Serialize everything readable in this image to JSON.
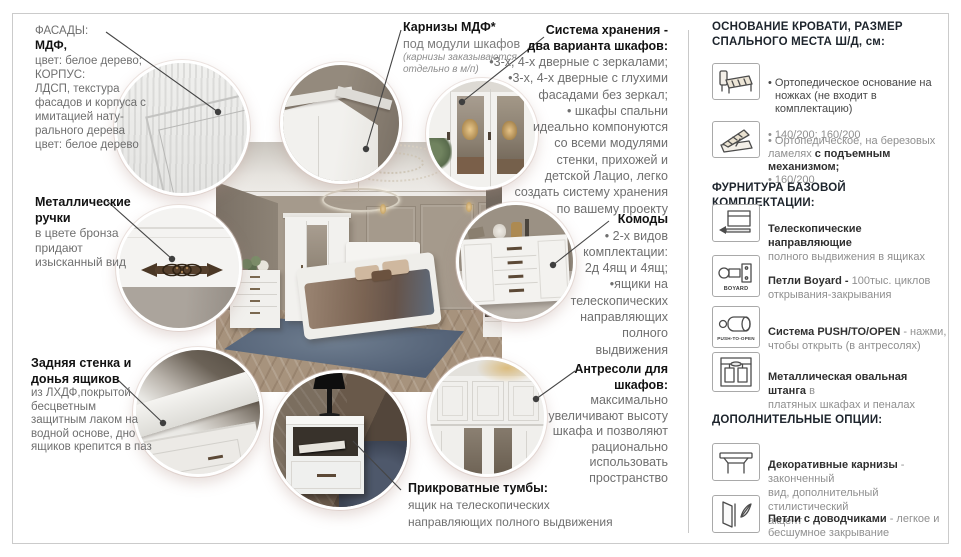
{
  "colors": {
    "body_gray": "#6f6f6f",
    "heading": "#121212",
    "sidebar_heading": "#1d242c",
    "leader_line": "#454545",
    "frame": "#cbcbcb"
  },
  "callouts": {
    "facades": {
      "label": "ФАСАДЫ:",
      "bold": "МДФ,",
      "body": "цвет: белое дерево;\nКОРПУС:\nЛДСП, текстура\nфасадов и корпуса с\nимитацией нату-\nрального дерева\nцвет: белое дерево"
    },
    "handles": {
      "title": "Металлические\nручки",
      "body": "в цвете бронза\nпридают\nизысканный вид"
    },
    "back_panel": {
      "title": "Задняя стенка и\nдонья ящиков",
      "body": "из ЛХДФ,покрытой\nбесцветным\nзащитным лаком на\nводной основе, дно\nящиков крепится в паз"
    },
    "cornices": {
      "title": "Карнизы МДФ*",
      "subtitle": "под модули шкафов",
      "note": "(карнизы заказываются\nотдельно в м/п)"
    },
    "storage": {
      "title": "Система хранения -\nдва варианта шкафов:",
      "body": "•3-х, 4-х дверные с зеркалами;\n•3-х, 4-х дверные с глухими\nфасадами без зеркал;\n• шкафы спальни\nидеально компонуются\nсо всеми модулями\nстенки, прихожей и\nдетской Лацио, легко\nсоздать систему хранения\nпо вашему проекту"
    },
    "dressers": {
      "title": "Комоды",
      "body": "• 2-х видов\nкомплектации:\n2д 4ящ и 4ящ;\n•ящики на\nтелескопических\nнаправляющих\nполного\nвыдвижения"
    },
    "mezzanines": {
      "title": "Антресоли для\nшкафов:",
      "body": "максимально\nувеличивают высоту\nшкафа и позволяют\nрационально\nиспользовать\nпространство"
    },
    "nightstands": {
      "title": "Прикроватные тумбы:",
      "body": "ящик на телескопических\nнаправляющих полного выдвижения"
    }
  },
  "sidebar": {
    "section1": {
      "title": "ОСНОВАНИЕ КРОВАТИ, РАЗМЕР\nСПАЛЬНОГО МЕСТА Ш/Д, см:",
      "items": [
        {
          "icon": "bed-base-icon",
          "dark": "• Ортопедическое основание на\nножках (не входит в комплектацию)",
          "gray": "• 140/200; 160/200"
        },
        {
          "icon": "lift-bed-icon",
          "gray1": "• Ортопедическое, на березовых\nламелях ",
          "bold": "с подъемным механизмом;",
          "gray2": "\n• 160/200"
        }
      ]
    },
    "section2": {
      "title": "ФУРНИТУРА БАЗОВОЙ КОМПЛЕКТАЦИИ:",
      "items": [
        {
          "icon": "telescopic-slides-icon",
          "lead": "Телескопические направляющие",
          "rest": "\nполного выдвижения в ящиках"
        },
        {
          "icon": "boyard-hinge-icon",
          "icon_label": "BOYARD",
          "lead": "Петли Boyard - ",
          "rest": "100тыс. циклов\nоткрывания-закрывания"
        },
        {
          "icon": "push-to-open-icon",
          "icon_label": "PUSH-TO-OPEN",
          "lead": "Система PUSH/TO/OPEN",
          "rest": " - нажми,\nчтобы открыть (в антресолях)"
        },
        {
          "icon": "oval-rod-icon",
          "lead": "Металлическая овальная штанга",
          "rest": " в\nплатяных шкафах и пеналах"
        }
      ]
    },
    "section3": {
      "title": "ДОПОЛНИТЕЛЬНЫЕ ОПЦИИ:",
      "items": [
        {
          "icon": "decorative-cornice-icon",
          "lead": "Декоративные карнизы",
          "rest": " - законченный\nвид, дополнительный стилистический\nакцент"
        },
        {
          "icon": "soft-close-hinge-icon",
          "lead": "Петли с доводчиками",
          "rest": " - легкое и\nбесшумное закрывание"
        }
      ]
    }
  },
  "icons": {
    "bed-base-icon": "bed on legs line-art",
    "lift-bed-icon": "bed with lifted mattress line-art",
    "telescopic-slides-icon": "drawer slide with arrow",
    "boyard-hinge-icon": "furniture hinge",
    "push-to-open-icon": "push latch cylinder",
    "oval-rod-icon": "wardrobe with hanging rod",
    "decorative-cornice-icon": "cornice profile",
    "soft-close-hinge-icon": "door with feather"
  }
}
